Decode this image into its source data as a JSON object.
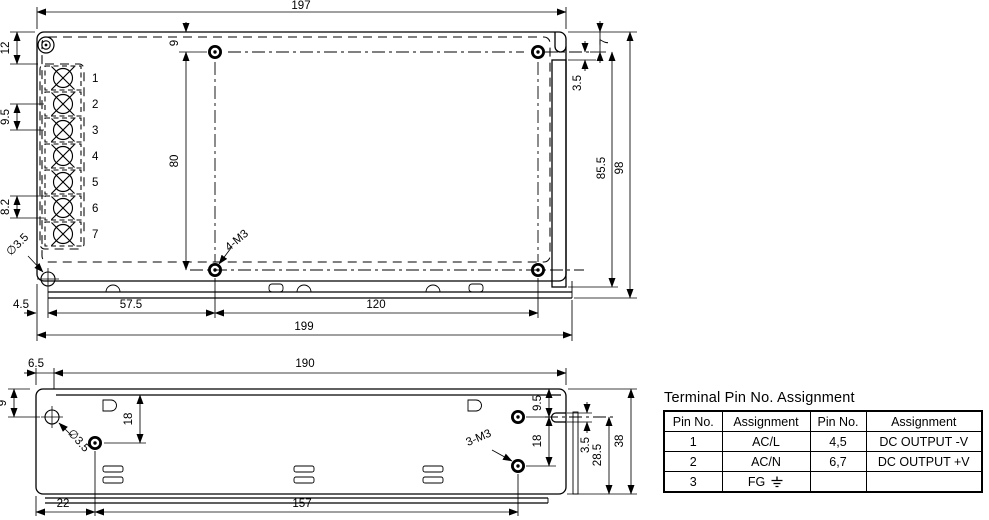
{
  "top_view": {
    "dim_width_top": "197",
    "dim_width_bottom": "199",
    "dim_left_top": "12",
    "dim_term_pitch": "9.5",
    "dim_term_pitch2": "8.2",
    "dim_hole_top": "9",
    "dim_hole_span_v": "80",
    "dim_foot": "4.5",
    "dim_hole_left": "57.5",
    "dim_hole_span_h": "120",
    "dim_notch_depth": "7",
    "dim_notch_gap": "3.5",
    "dim_body_height": "85.5",
    "dim_height": "98",
    "label_mounting_holes": "4-M3",
    "label_corner_hole": "∅3.5",
    "terminals": [
      "1",
      "2",
      "3",
      "4",
      "5",
      "6",
      "7"
    ]
  },
  "side_view": {
    "dim_lip": "6.5",
    "dim_width": "190",
    "dim_hole_top_left": "9",
    "dim_hole_drop_left": "18",
    "dim_hole_top_right": "9.5",
    "dim_hole_gap_right": "18",
    "dim_slot": "3.5",
    "dim_hole_bottom": "28.5",
    "dim_height": "38",
    "dim_hole_left": "22",
    "dim_hole_span": "157",
    "label_mounting_holes": "3-M3",
    "label_hole_dia": "∅3.5"
  },
  "pin_table": {
    "title": "Terminal Pin No. Assignment",
    "headers": [
      "Pin No.",
      "Assignment",
      "Pin No.",
      "Assignment"
    ],
    "rows": [
      [
        "1",
        "AC/L",
        "4,5",
        "DC OUTPUT -V"
      ],
      [
        "2",
        "AC/N",
        "6,7",
        "DC OUTPUT +V"
      ],
      [
        "3",
        "FG",
        "",
        ""
      ]
    ],
    "icons": {
      "ground": "earth-ground"
    }
  }
}
